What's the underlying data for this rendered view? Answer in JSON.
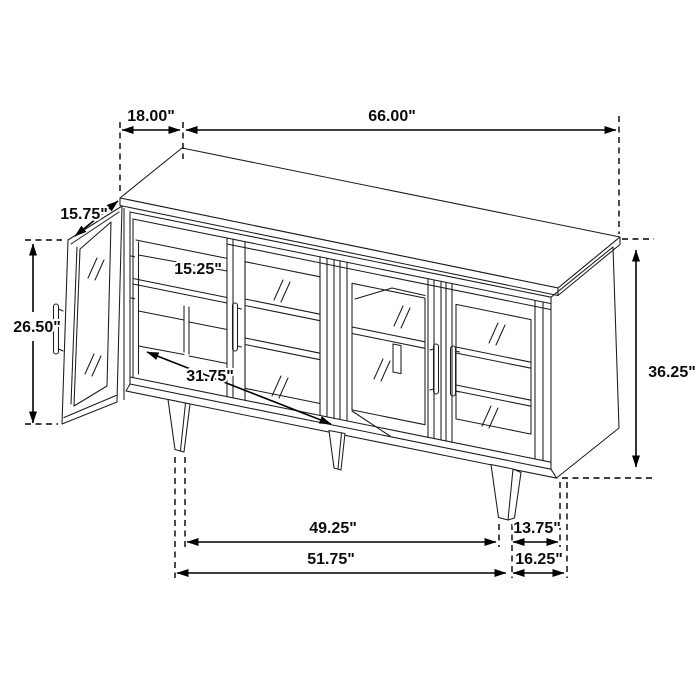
{
  "diagram": {
    "kind": "furniture dimension line drawing",
    "subject": "4-door glass sideboard cabinet with one door open",
    "unit": "inches"
  },
  "dimensions": {
    "top_depth": "18.00\"",
    "overall_width": "66.00\"",
    "door_width": "15.75\"",
    "shelf_depth": "15.25\"",
    "door_height": "26.50\"",
    "interior_width": "31.75\"",
    "overall_height": "36.25\"",
    "leg_span_inner": "49.25\"",
    "leg_to_corner_upper": "13.75\"",
    "leg_span_outer": "51.75\"",
    "leg_to_corner_lower": "16.25\""
  }
}
